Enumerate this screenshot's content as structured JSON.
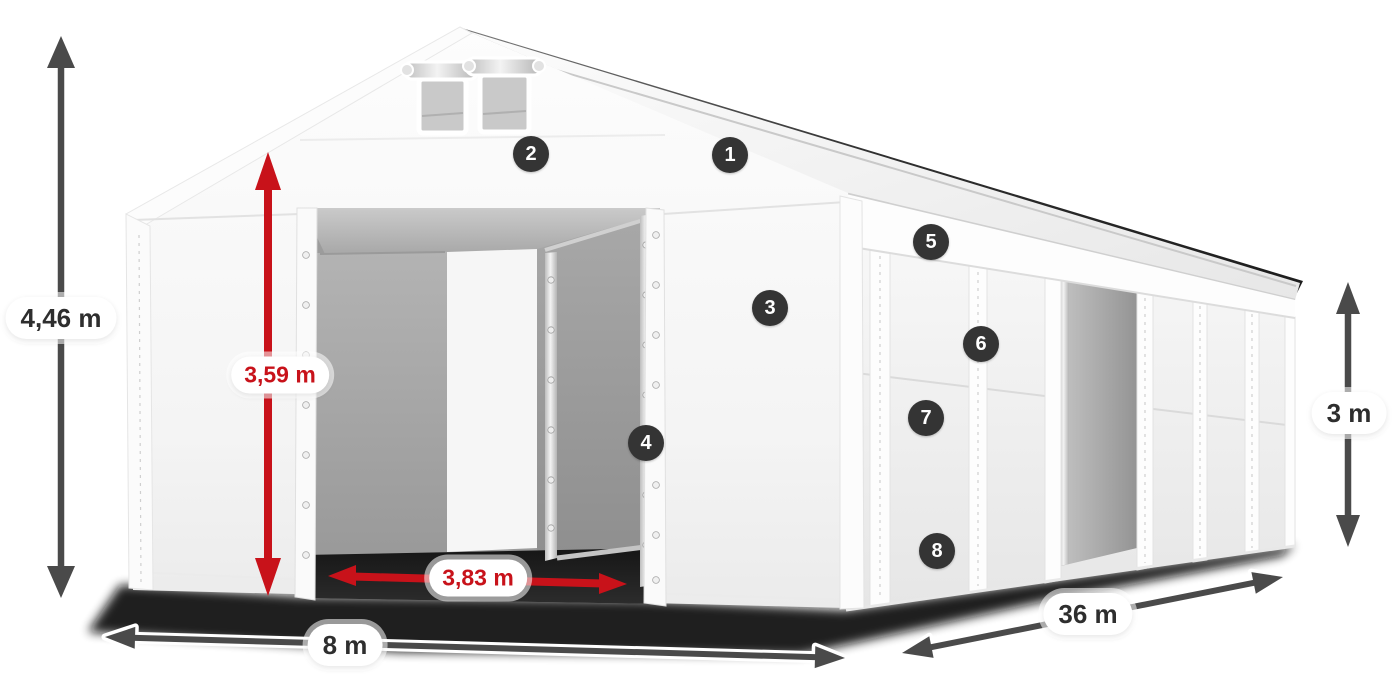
{
  "diagram": {
    "type": "tent-dimension-diagram",
    "labels": {
      "total_height": "4,46 m",
      "entrance_height": "3,59 m",
      "entrance_width": "3,83 m",
      "gable_width": "8 m",
      "length": "36 m",
      "wall_height": "3 m"
    },
    "markers": [
      "1",
      "2",
      "3",
      "4",
      "5",
      "6",
      "7",
      "8"
    ],
    "colors": {
      "dimension_arrow": "#4a4a4a",
      "highlight_arrow": "#c8121a",
      "marker_background": "#343434",
      "label_background": "#ffffff",
      "label_text": "#2e2e2e"
    }
  }
}
